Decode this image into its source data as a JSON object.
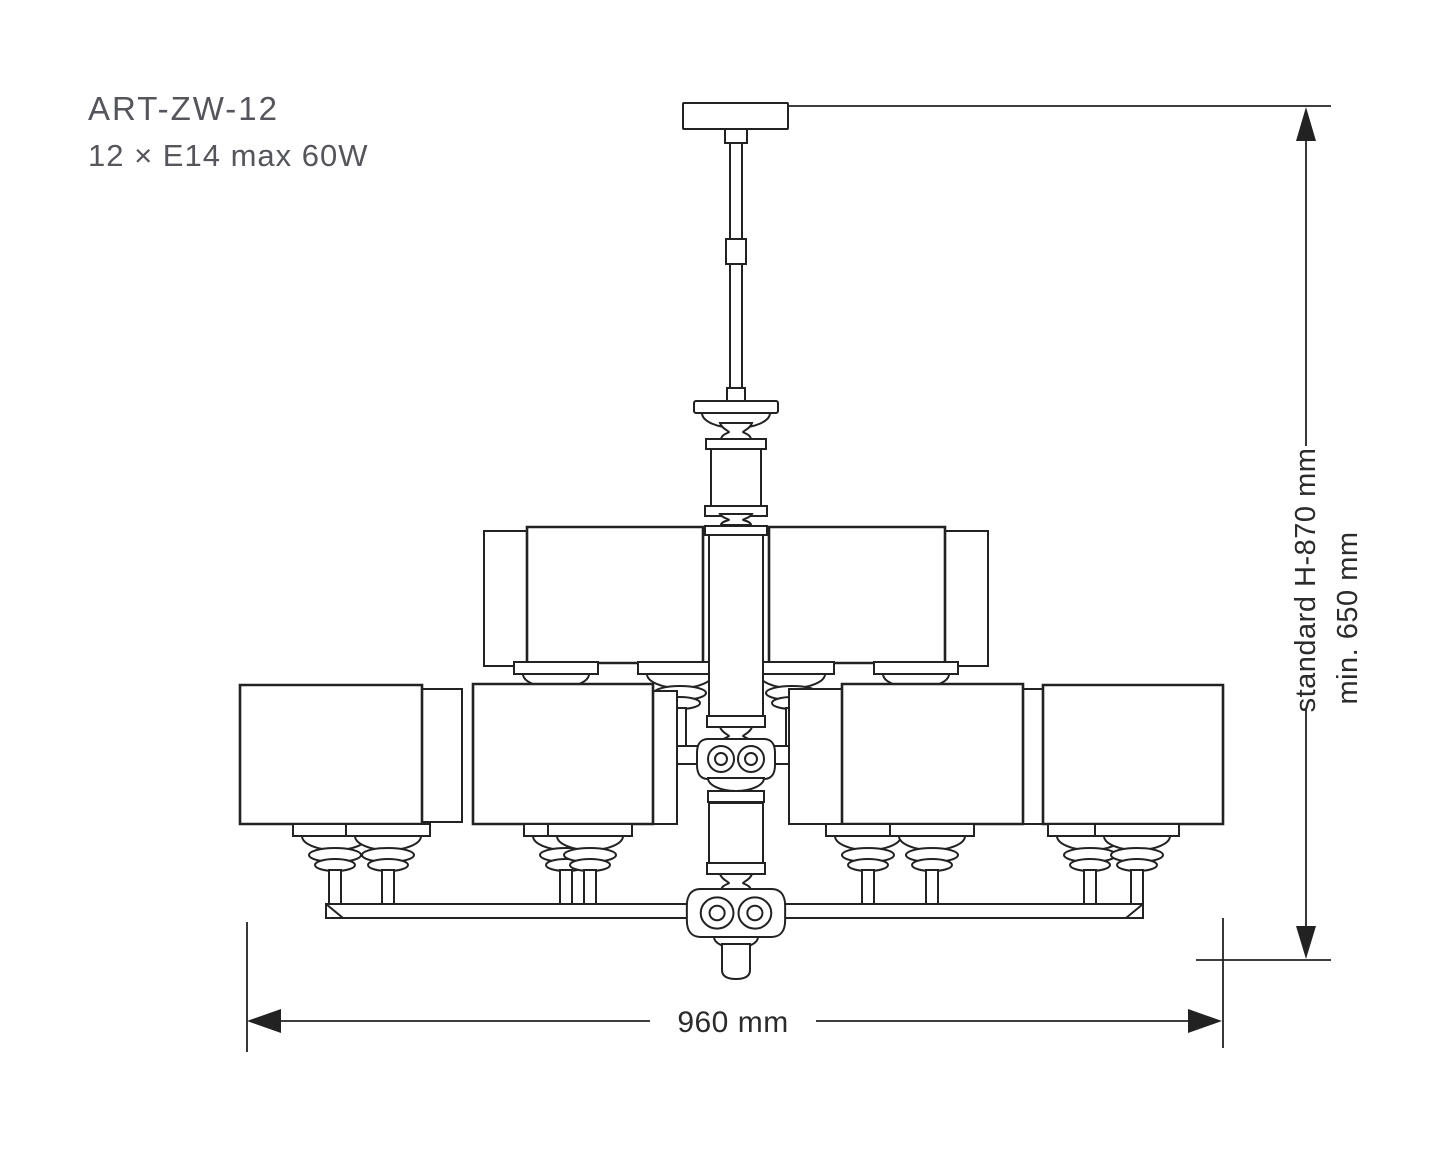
{
  "drawing": {
    "product_code": "ART-ZW-12",
    "lamp_spec": "12 × E14 max 60W",
    "dimensions": {
      "height_standard": "standard H-870 mm",
      "height_min": "min. 650 mm",
      "width": "960 mm"
    },
    "colors": {
      "line": "#222222",
      "label_text": "#55565b",
      "dimension_text": "#2b2b2b",
      "background": "#ffffff"
    }
  }
}
